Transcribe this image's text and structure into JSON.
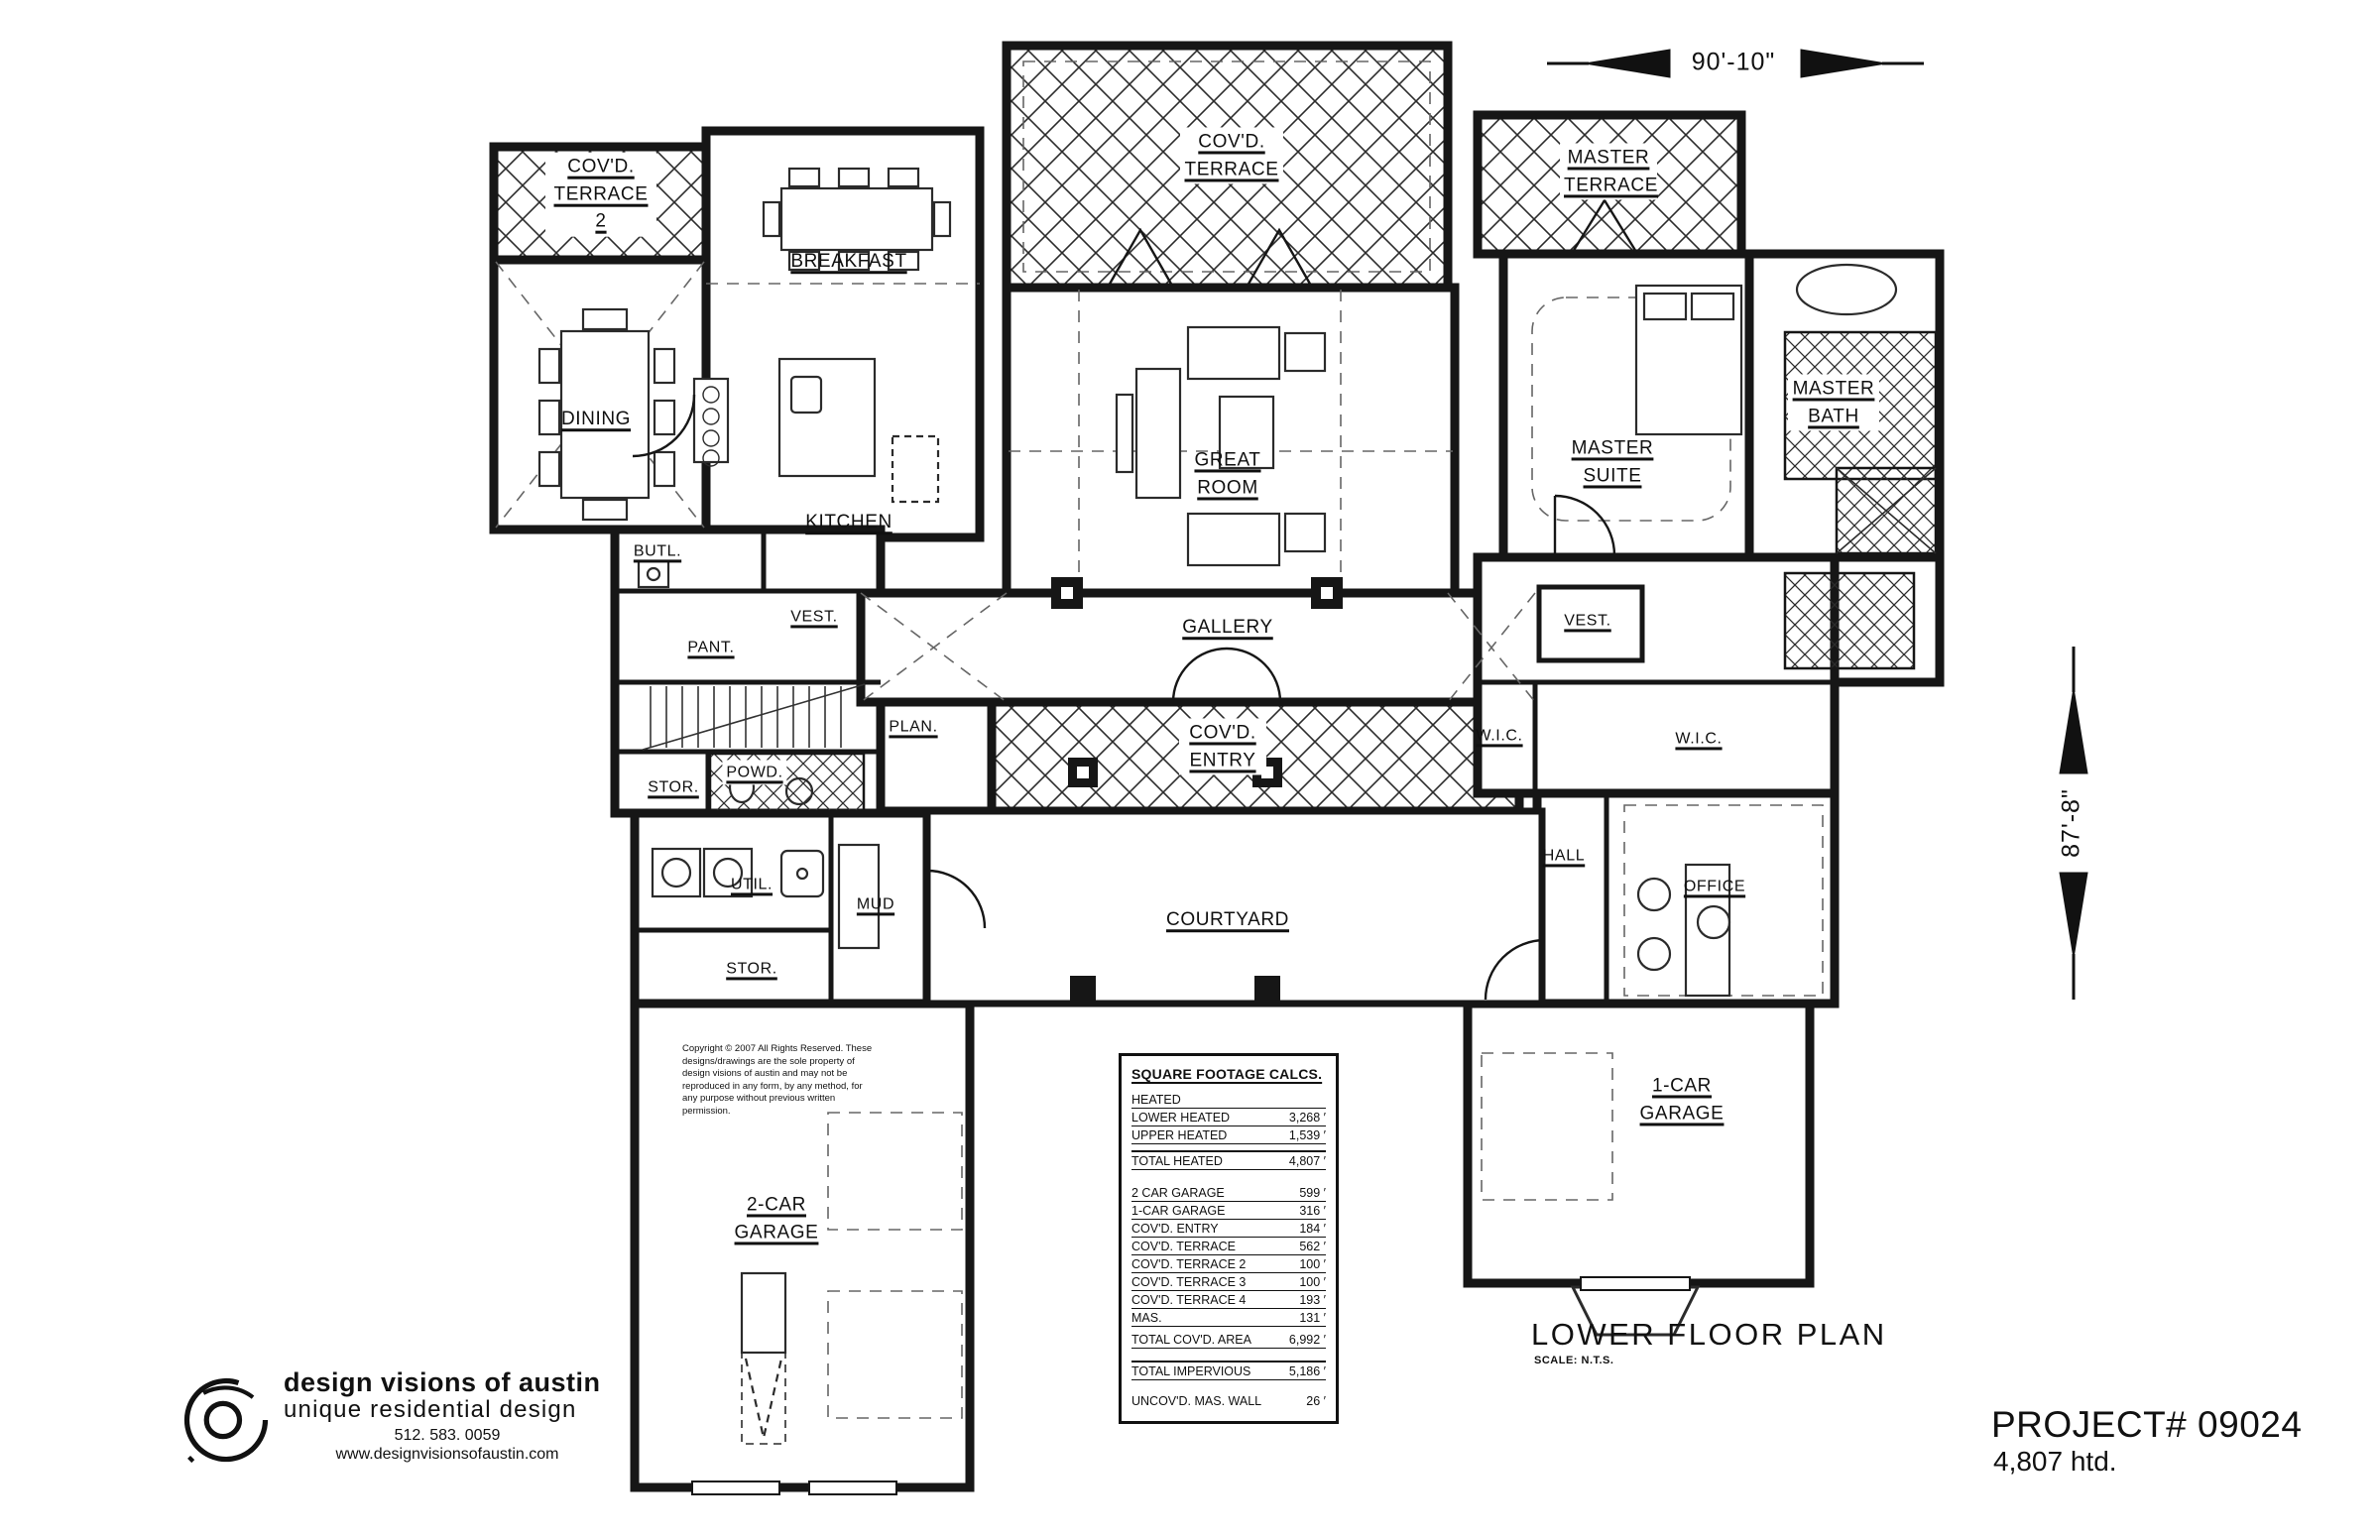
{
  "sheet": {
    "dimension_top": "90'-10\"",
    "dimension_right": "87'-8\"",
    "plan_title": "LOWER FLOOR PLAN",
    "plan_scale": "SCALE: N.T.S.",
    "project_number": "PROJECT# 09024",
    "project_heated": "4,807 htd."
  },
  "logo": {
    "name": "design visions of austin",
    "tagline": "unique residential design",
    "phone": "512. 583. 0059",
    "website": "www.designvisionsofaustin.com"
  },
  "copyright": "Copyright © 2007 All Rights Reserved. These designs/drawings are the sole property of design visions of austin and may not be reproduced in any form, by any method, for any purpose without previous written permission.",
  "rooms": {
    "covd_terrace_2": "COV'D. TERRACE 2",
    "breakfast": "BREAKFAST",
    "covd_terrace": "COV'D. TERRACE",
    "master_terrace": "MASTER TERRACE",
    "dining": "DINING",
    "kitchen": "KITCHEN",
    "great_room": "GREAT ROOM",
    "master_suite": "MASTER SUITE",
    "master_bath": "MASTER BATH",
    "butl": "BUTL.",
    "vest_left": "VEST.",
    "gallery": "GALLERY",
    "vest_right": "VEST.",
    "pant": "PANT.",
    "plan_room": "PLAN.",
    "covd_entry": "COV'D. ENTRY",
    "wic_small": "W.I.C.",
    "wic_large": "W.I.C.",
    "stor_upper": "STOR.",
    "powd": "POWD.",
    "hall": "HALL",
    "office": "OFFICE",
    "util": "UTIL.",
    "mud": "MUD",
    "courtyard": "COURTYARD",
    "stor_lower": "STOR.",
    "garage_2car": "2-CAR GARAGE",
    "garage_1car": "1-CAR GARAGE"
  },
  "sqft_table": {
    "title": "SQUARE FOOTAGE CALCS.",
    "rows": [
      {
        "label": "HEATED",
        "value": ""
      },
      {
        "label": "LOWER HEATED",
        "value": "3,268 ′"
      },
      {
        "label": "UPPER HEATED",
        "value": "1,539 ′"
      },
      {
        "label": "TOTAL HEATED",
        "value": "4,807 ′"
      },
      {
        "label": "2 CAR GARAGE",
        "value": "599 ′"
      },
      {
        "label": "1-CAR GARAGE",
        "value": "316 ′"
      },
      {
        "label": "COV'D. ENTRY",
        "value": "184 ′"
      },
      {
        "label": "COV'D. TERRACE",
        "value": "562 ′"
      },
      {
        "label": "COV'D. TERRACE 2",
        "value": "100 ′"
      },
      {
        "label": "COV'D. TERRACE 3",
        "value": "100 ′"
      },
      {
        "label": "COV'D. TERRACE 4",
        "value": "193 ′"
      },
      {
        "label": "MAS.",
        "value": "131 ′"
      },
      {
        "label": "TOTAL COV'D. AREA",
        "value": "6,992 ′"
      },
      {
        "label": "TOTAL IMPERVIOUS",
        "value": "5,186 ′"
      },
      {
        "label": "UNCOV'D. MAS. WALL",
        "value": "26 ′"
      }
    ]
  }
}
